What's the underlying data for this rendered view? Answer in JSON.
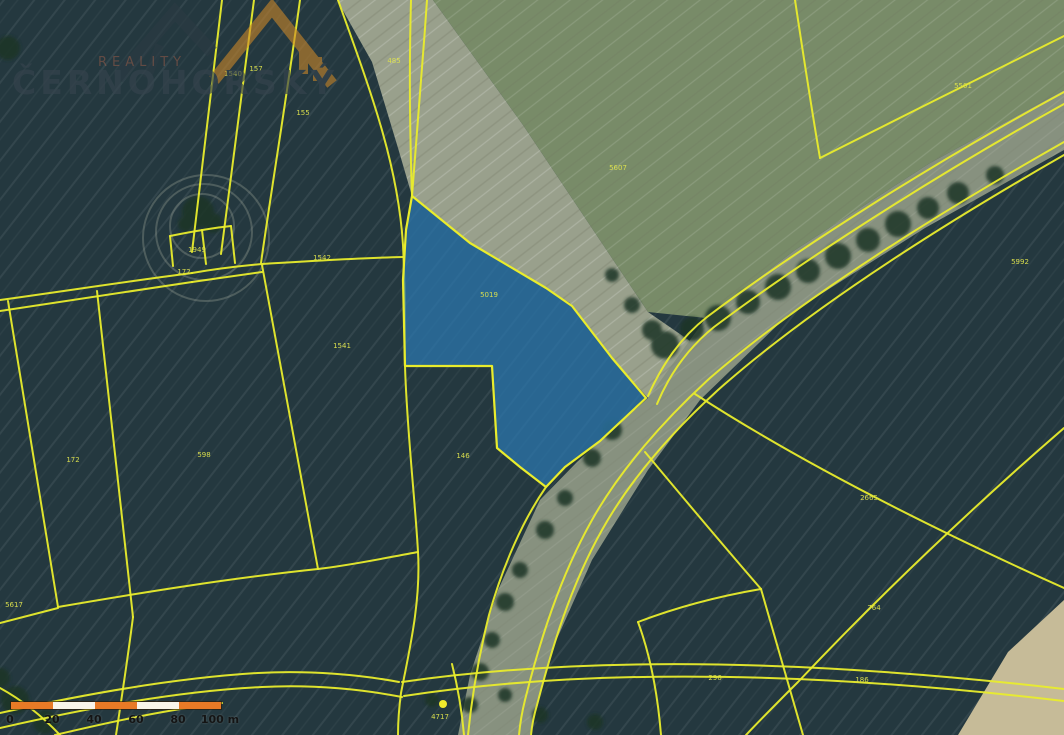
{
  "map": {
    "type": "cadastral-orthophoto",
    "highlighted_parcel": {
      "label": "5019",
      "fill": "#2b79b2",
      "stroke": "#e9ec2c"
    },
    "poi": {
      "label": "4717"
    },
    "colors": {
      "boundary_yellow": "#e9ec2c",
      "parcel_fill_blue": "#2b79b2",
      "scalebar_orange": "#e87a26",
      "scalebar_white": "#f8f5ea"
    },
    "parcel_labels": [
      {
        "text": "1540",
        "x": 233,
        "y": 76
      },
      {
        "text": "157",
        "x": 256,
        "y": 71
      },
      {
        "text": "155",
        "x": 303,
        "y": 115
      },
      {
        "text": "485",
        "x": 394,
        "y": 63
      },
      {
        "text": "5607",
        "x": 618,
        "y": 170
      },
      {
        "text": "5501",
        "x": 963,
        "y": 88
      },
      {
        "text": "5992",
        "x": 1020,
        "y": 264
      },
      {
        "text": "1949",
        "x": 197,
        "y": 252,
        "color": "#d98a3c"
      },
      {
        "text": "172",
        "x": 184,
        "y": 274
      },
      {
        "text": "1542",
        "x": 322,
        "y": 260
      },
      {
        "text": "1541",
        "x": 342,
        "y": 348
      },
      {
        "text": "598",
        "x": 204,
        "y": 457
      },
      {
        "text": "172",
        "x": 73,
        "y": 462
      },
      {
        "text": "5617",
        "x": 14,
        "y": 607
      },
      {
        "text": "146",
        "x": 463,
        "y": 458
      },
      {
        "text": "2665",
        "x": 869,
        "y": 500
      },
      {
        "text": "764",
        "x": 874,
        "y": 610
      },
      {
        "text": "186",
        "x": 862,
        "y": 682
      },
      {
        "text": "296",
        "x": 715,
        "y": 680
      },
      {
        "text": "4717",
        "x": 440,
        "y": 719
      },
      {
        "text": "5019",
        "x": 489,
        "y": 297,
        "color": "#8fae3d"
      }
    ]
  },
  "scalebar": {
    "tick_labels": [
      "0",
      "20",
      "40",
      "60",
      "80",
      "100 m"
    ],
    "segment_colors": [
      "#e87a26",
      "#f8f5ea",
      "#e87a26",
      "#f8f5ea",
      "#e87a26"
    ]
  },
  "watermark": {
    "brand": "ČERNOHORSKÝ",
    "subtitle": "REALITY"
  }
}
